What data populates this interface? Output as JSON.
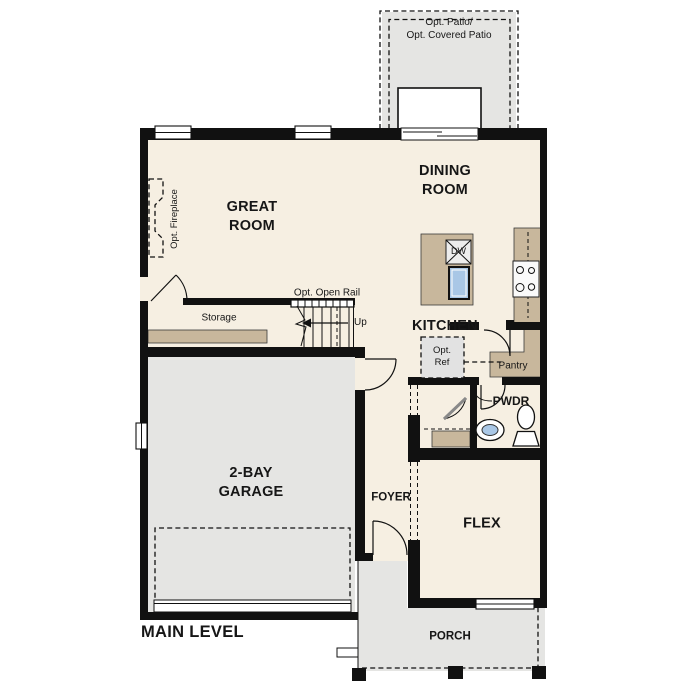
{
  "colors": {
    "wall": "#111111",
    "floor": "#f6efe2",
    "hard": "#e5e5e3",
    "tan": "#c8b79c",
    "sink": "#a9c7e6"
  },
  "labels": {
    "patio": "Opt. Patio/\nOpt. Covered Patio",
    "dining_room": "DINING\nROOM",
    "great_room": "GREAT\nROOM",
    "fireplace": "Opt. Fireplace",
    "open_rail": "Opt. Open Rail",
    "up": "Up",
    "storage": "Storage",
    "kitchen": "KITCHEN",
    "dishwasher": "DW",
    "refrigerator": "Opt.\nRef",
    "pantry": "Pantry",
    "powder": "PWDR",
    "garage": "2-BAY\nGARAGE",
    "foyer": "FOYER",
    "flex": "FLEX",
    "porch": "PORCH",
    "level_title": "MAIN LEVEL"
  }
}
